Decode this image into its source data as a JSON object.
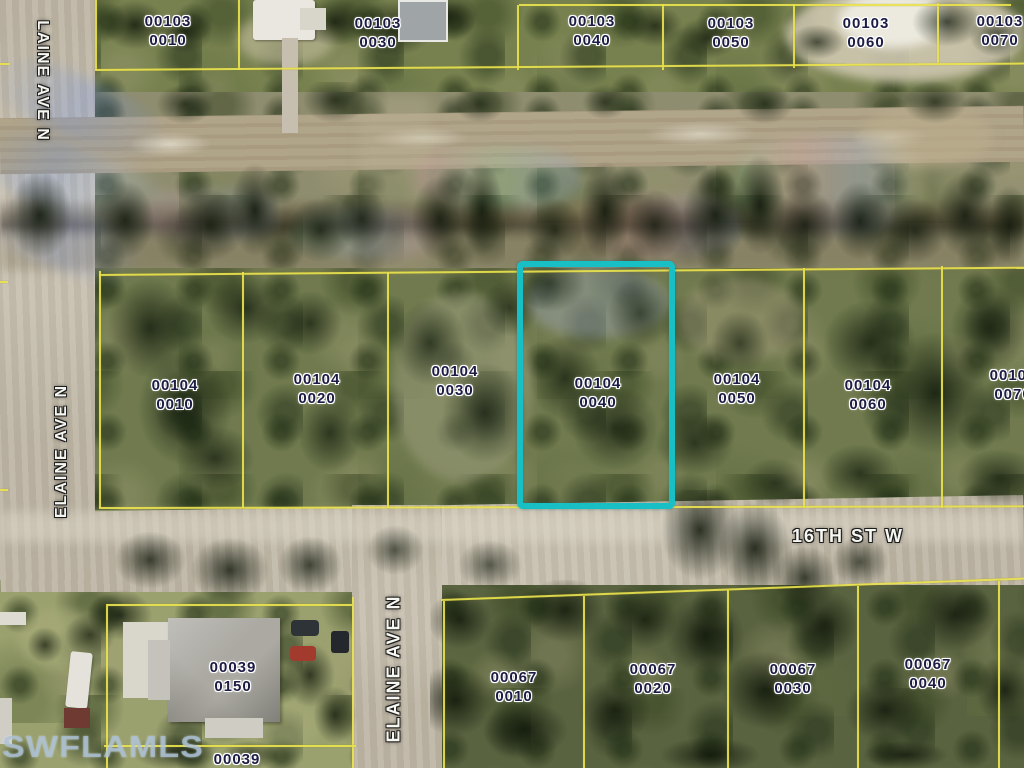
{
  "map_photo": {
    "watermark_text": "SWFLAMLS",
    "highlight_color": "#18c0c6",
    "parcel_line_color": "#e9e24e",
    "streets": {
      "top_left": "LAINE AVE N",
      "mid_left": "ELAINE AVE N",
      "bottom": "ELAINE AVE N",
      "cross": "16TH ST W"
    },
    "parcels": {
      "top_row": [
        {
          "block": "00103",
          "lot": "0010"
        },
        {
          "block": "00103",
          "lot": "0030"
        },
        {
          "block": "00103",
          "lot": "0040"
        },
        {
          "block": "00103",
          "lot": "0050"
        },
        {
          "block": "00103",
          "lot": "0060"
        },
        {
          "block": "00103",
          "lot": "0070"
        }
      ],
      "middle_row": [
        {
          "block": "00104",
          "lot": "0010"
        },
        {
          "block": "00104",
          "lot": "0020"
        },
        {
          "block": "00104",
          "lot": "0030"
        },
        {
          "block": "00104",
          "lot": "0040"
        },
        {
          "block": "00104",
          "lot": "0050"
        },
        {
          "block": "00104",
          "lot": "0060"
        },
        {
          "block": "00104",
          "lot": "0070"
        }
      ],
      "bottom_left_parcel": {
        "block": "00039",
        "lot": "0150"
      },
      "bottom_edge_parcel": {
        "block": "00039",
        "lot": ""
      },
      "bottom_row": [
        {
          "block": "00067",
          "lot": "0010"
        },
        {
          "block": "00067",
          "lot": "0020"
        },
        {
          "block": "00067",
          "lot": "0030"
        },
        {
          "block": "00067",
          "lot": "0040"
        }
      ],
      "left_edge_partial": "9",
      "highlighted_parcel": "00104 0040"
    }
  }
}
